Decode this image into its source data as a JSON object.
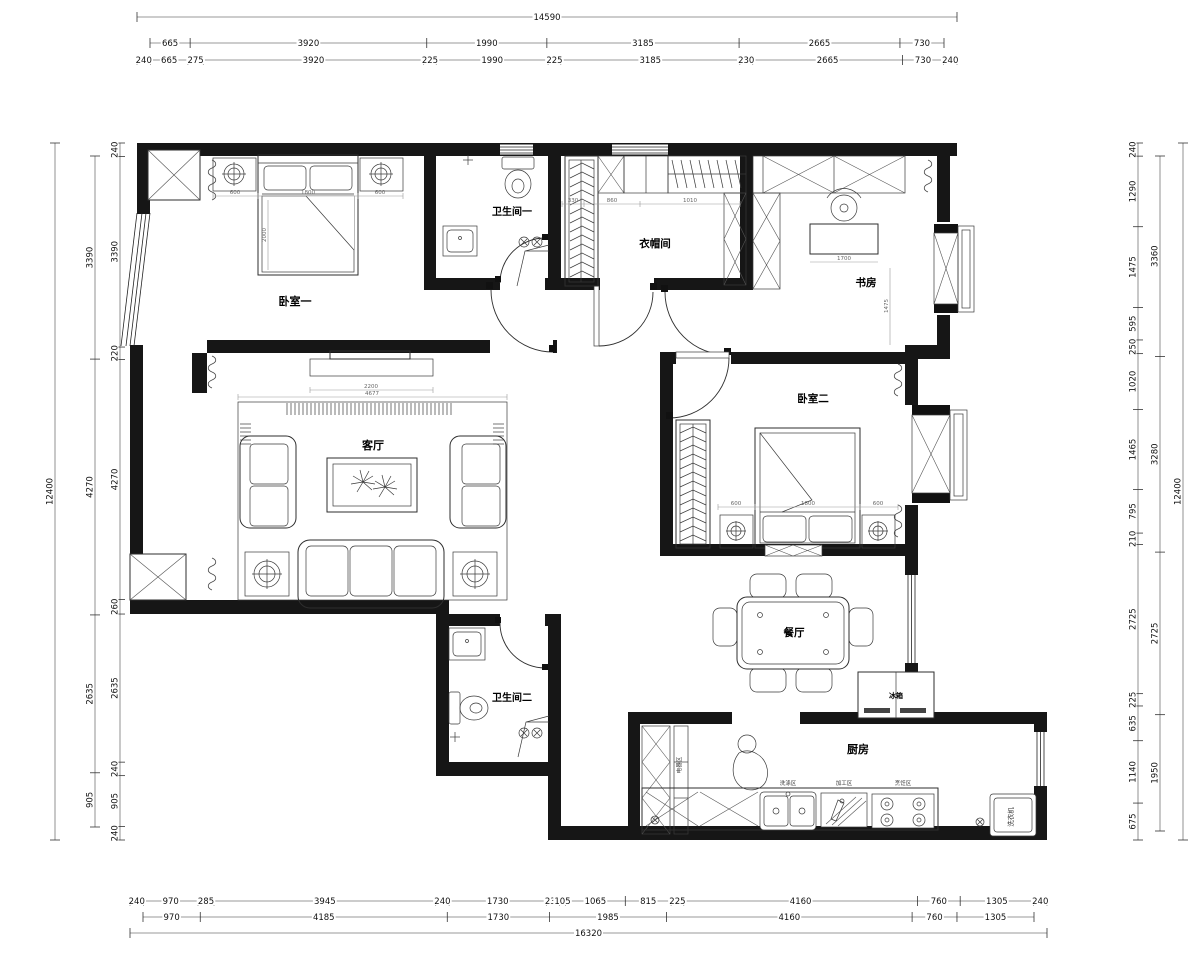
{
  "rooms": {
    "bedroom1": "卧室一",
    "bathroom1": "卫生间一",
    "cloakroom": "衣帽间",
    "study": "书房",
    "living": "客厅",
    "bedroom2": "卧室二",
    "dining": "餐厅",
    "bathroom2": "卫生间二",
    "kitchen": "厨房",
    "fridge": "冰箱",
    "washer": "洗衣机",
    "appliance_zone": "电器区",
    "wash_zone": "洗涤区",
    "prep_zone": "加工区",
    "cook_zone": "烹饪区"
  },
  "dims": {
    "top": {
      "total": [
        "14590"
      ],
      "row2": [
        "665",
        "3920",
        "1990",
        "3185",
        "2665",
        "730"
      ],
      "row3": [
        "240",
        "665",
        "275",
        "3920",
        "225",
        "1990",
        "225",
        "3185",
        "230",
        "2665",
        "730",
        "240"
      ]
    },
    "bottom": {
      "row1": [
        "240",
        "970",
        "285",
        "3945",
        "240",
        "1730",
        "235",
        "105",
        "1065",
        "815",
        "225",
        "4160",
        "760",
        "1305",
        "240"
      ],
      "row2": [
        "970",
        "4185",
        "1730",
        "1985",
        "4160",
        "760",
        "1305"
      ],
      "total": [
        "16320"
      ]
    },
    "left": {
      "total": [
        "12400"
      ],
      "mid": [
        "3390",
        "4270",
        "2635",
        "905"
      ],
      "inner": [
        "240",
        "3390",
        "220",
        "4270",
        "260",
        "2635",
        "240",
        "905",
        "240"
      ]
    },
    "right": {
      "inner": [
        "240",
        "1290",
        "1475",
        "595",
        "250",
        "1020",
        "1465",
        "795",
        "210",
        "2725",
        "225",
        "635",
        "1140",
        "675"
      ],
      "mid": [
        "3360",
        "3280",
        "2725",
        "1950"
      ],
      "total": [
        "12400"
      ]
    }
  },
  "idims": [
    "600",
    "1800",
    "600",
    "2000",
    "600",
    "1800",
    "600",
    "2200",
    "4677",
    "330",
    "860",
    "1010",
    "1700",
    "1475"
  ]
}
